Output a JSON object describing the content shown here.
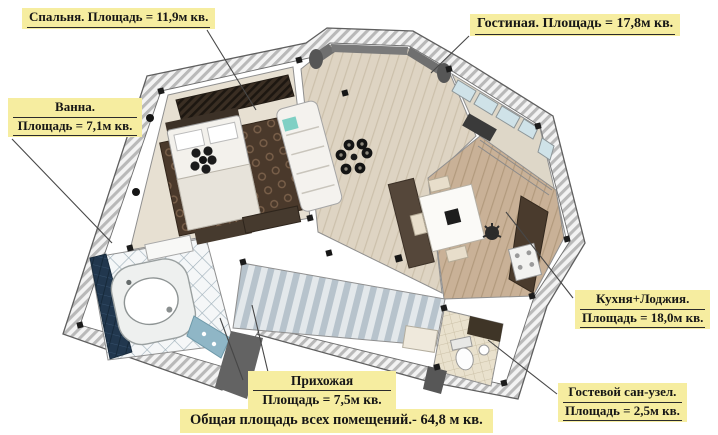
{
  "title": "Apartment floor plan with room areas",
  "labels": {
    "bedroom": {
      "text": "Спальня. Площадь = 11,9м кв."
    },
    "living_room": {
      "text": "Гостиная. Площадь = 17,8м кв."
    },
    "bathroom": {
      "line1": "Ванна.",
      "line2": "Площадь = 7,1м кв."
    },
    "kitchen_loggia": {
      "line1": "Кухня+Лоджия.",
      "line2": "Площадь = 18,0м кв."
    },
    "hallway": {
      "line1": "Прихожая",
      "line2": "Площадь = 7,5м кв."
    },
    "guest_wc": {
      "line1": "Гостевой сан-узел.",
      "line2": "Площадь = 2,5м кв."
    },
    "total": {
      "text": "Общая площадь всех помещений.- 64,8 м кв."
    }
  },
  "rooms": [
    {
      "name": "Спальня",
      "area": "11,9 м кв."
    },
    {
      "name": "Гостиная",
      "area": "17,8 м кв."
    },
    {
      "name": "Ванна",
      "area": "7,1 м кв."
    },
    {
      "name": "Кухня+Лоджия",
      "area": "18,0 м кв."
    },
    {
      "name": "Прихожая",
      "area": "7,5 м кв."
    },
    {
      "name": "Гостевой сан-узел",
      "area": "2,5 м кв."
    },
    {
      "name": "Общая площадь всех помещений",
      "area": "64,8 м кв."
    }
  ],
  "colors": {
    "label_bg": "#f6eda0",
    "label_text": "#161616",
    "wall_hatch": "#b9b9b9",
    "living_floor": "#ded4c3",
    "kitchen_floor": "#c9b197",
    "hall_floor": "#b7c3cc",
    "bath_wall_tile": "#21374e",
    "bedroom_rug": "#4a392b"
  }
}
